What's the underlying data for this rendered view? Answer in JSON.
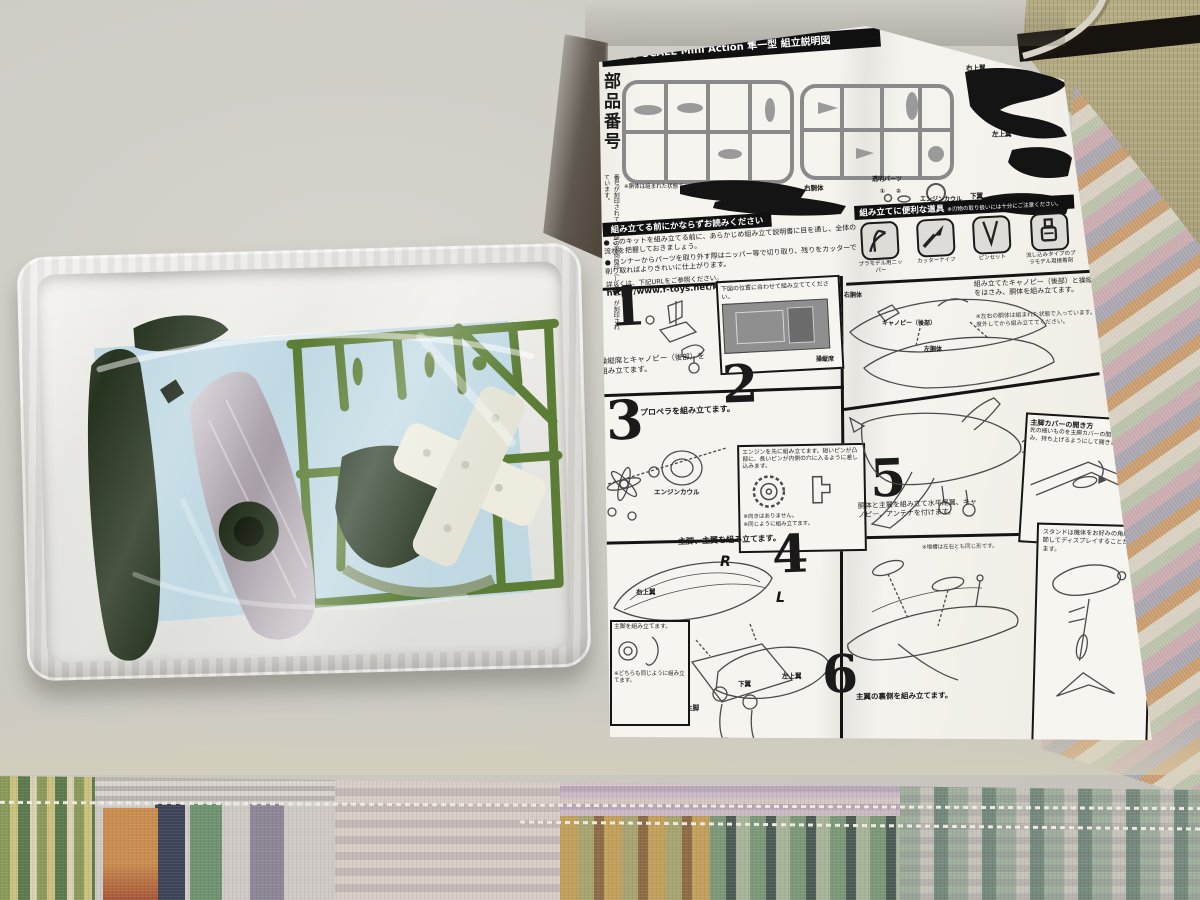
{
  "sheet": {
    "header_title": "1/100 SCALE Mini Action 隼一型 組立説明図",
    "parts_section": {
      "title": "部品番号",
      "note": "番号が刻印されている面の裏側に印（しるし）が刻印されています。",
      "sprue_note": "※胴体は組まれた状態で入っています。",
      "labels": {
        "right_upper_wing": "右上翼",
        "left_upper_wing": "左上翼",
        "right_fuselage": "右胴体",
        "left_fuselage": "左胴体",
        "clear_parts": "透明パーツ",
        "num1": "①",
        "num2": "②",
        "engine_cowl": "エンジンカウル",
        "lower_wing": "下翼"
      }
    },
    "warning": {
      "title": "組み立てる前にかならずお読みください",
      "bullet1": "● このキットを組み立てる前に、あらかじめ組み立て説明書に目を通し、全体の流れを把握しておきましょう。",
      "bullet2": "● ランナーからパーツを取り外す際はニッパー等で切り取り、残りをカッターで削り取ればよりきれいに仕上がります。",
      "url_lead": "詳しくは、下記URLをご参照ください。",
      "url": "http://www.f-toys.net/kumitate/detail.html"
    },
    "tools": {
      "title": "組み立てに便利な道具",
      "caution": "※刃物の取り扱いには十分にご注意ください。",
      "items": [
        "プラモデル用ニッパー",
        "カッターナイフ",
        "ピンセット",
        "流し込みタイプのプラモデル用接着剤"
      ]
    },
    "steps": [
      {
        "num": "1",
        "text": "操縦席とキャノピー（後部）を組み立てます。",
        "note": "下図の位置に合わせて組み立ててください。"
      },
      {
        "num": "2",
        "text": "組み立てたキャノピー（後部）と操縦席をはさみ、胴体を組み立てます。",
        "note": "※左右の胴体は組まれた状態で入っています。一度外してから組み立ててください。",
        "label_right_fuselage": "右胴体",
        "label_canopy": "キャノピー（後部）",
        "label_left_fuselage": "左胴体",
        "label_cockpit": "操縦席"
      },
      {
        "num": "3",
        "text": "プロペラを組み立てます。",
        "label_engine_cowl": "エンジンカウル",
        "inset_text": "エンジンを先に組み立てます。短いピンが凸部に、長いピンが内側の穴に入るように差し込みます。",
        "inset_note1": "※向きはありません。",
        "inset_note2": "※同じように組み立てます。"
      },
      {
        "num": "4",
        "text": "主脚、主翼を組み立てます。",
        "inset_text": "主脚を組み立てます。",
        "inset_note": "※どちらも同じように組み立てます。",
        "label_right_upper_wing": "右上翼",
        "label_left_upper_wing": "左上翼",
        "label_lower_wing": "下翼",
        "label_main_gear": "主脚",
        "mark_r": "R",
        "mark_l": "L"
      },
      {
        "num": "5",
        "text": "胴体と主翼を組み立て水平尾翼、キャノピー、アンテナを付けます。",
        "box_title": "主脚カバーの開き方",
        "box_text": "先の細いものを主脚カバーの間に差し込み、持ち上げるようにして開きます。"
      },
      {
        "num": "6",
        "text": "主翼の裏側を組み立てます。",
        "note": "※増槽は左右とも同じ形です。"
      }
    ],
    "stand_note": "スタンドは機体をお好みの角度に調節してディスプレイすることができます。"
  }
}
